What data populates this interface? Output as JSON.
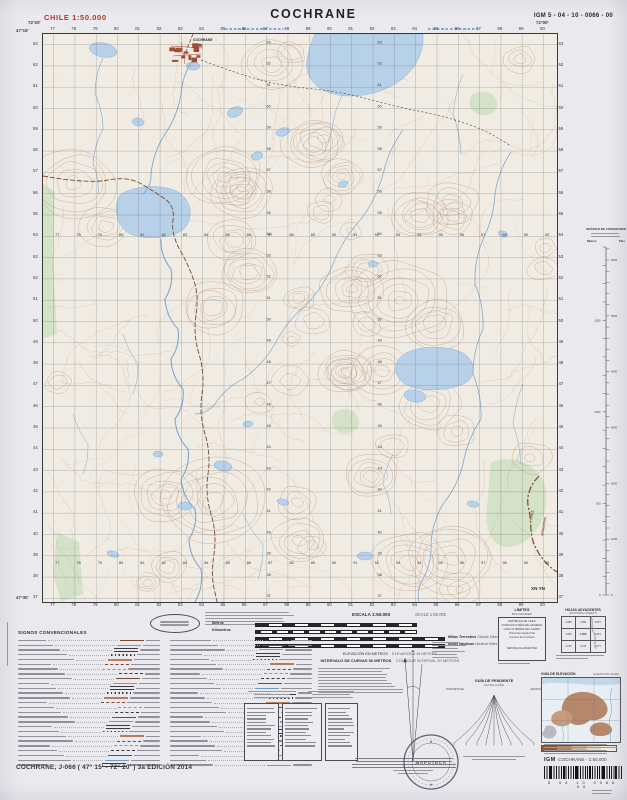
{
  "header": {
    "country_scale": "CHILE  1:50.000",
    "title": "COCHRANE",
    "sheet_code": "IGM 5 - 04 - 10 - 0066 - 00"
  },
  "map": {
    "town_label": "COCHRANE",
    "border_label_left": "CHILE",
    "border_label_right": "ARGENTINA",
    "zone_label": "XN YN",
    "corner_top_left_lon": "72°20'",
    "corner_top_right_lon": "72°00'",
    "corner_top_left_lat": "47°15'",
    "corner_bottom_left_lat": "47°30'",
    "grid": {
      "easting_start": 77,
      "easting_count": 24,
      "northing_start": 63,
      "northing_count": 27,
      "interior_rows": [
        202,
        530
      ],
      "interior_cols": [
        222,
        333
      ]
    }
  },
  "conversion": {
    "title": "GRÁFICO DE CONVERSIÓN",
    "col_meters": "Metros",
    "col_feet": "Pies",
    "meters_max": 1900,
    "meters_step": 100
  },
  "legend": {
    "signos_title": "SIGNOS CONVENCIONALES",
    "scale_es": "ESCALA 1:50.000",
    "scale_en": "SCALE 1:50.000",
    "scale_bars": [
      "Metros",
      "Kilómetros",
      "Millas Terrestres",
      "Millas Náuticas"
    ],
    "scale_bars_en": [
      "",
      "",
      "Statute Miles",
      "Nautical Miles"
    ],
    "elevation_es": "ELEVACIÓN EN METROS",
    "elevation_en": "ELEVATIONS IN METERS",
    "interval_es": "INTERVALO DE CURVAS 50 METROS",
    "interval_en": "CONTOUR INTERVAL 50 METERS",
    "limits": {
      "title_es": "LÍMITES",
      "title_en": "BOUNDARIES",
      "lines": [
        "REPÚBLICA DE CHILE",
        "XI REGIÓN AYSÉN DEL GENERAL",
        "CARLOS IBÁÑEZ DEL CAMPO",
        "Provincia Capitán Prat",
        "Comuna de Cochrane",
        "REPÚBLICA ARGENTINA"
      ]
    },
    "adjoining": {
      "title_es": "HOJAS ADYACENTES",
      "title_en": "ADJOINING SHEETS",
      "sheets": [
        "J-055",
        "J-056",
        "J-057",
        "J-065",
        "J-066",
        "J-067",
        "J-075",
        "J-076",
        "J-077"
      ],
      "current": "J-066"
    },
    "slope": {
      "title_es": "GUÍA DE PENDIENTE",
      "title_en": "SLOPE GUIDE",
      "left": "PORCENTAJE",
      "right": "GRADOS"
    },
    "elev_guide": {
      "title_es": "GUÍA DE ELEVACIÓN",
      "title_en": "ELEVATION GUIDE"
    }
  },
  "footer": {
    "edition": "COCHRANE, J-066 ( 47° 15' - 72° 20' ) 3a EDICIÓN 2014",
    "igm_label": "IGM",
    "product": "COCHRANE - 1:50.000",
    "barcode_digits": "5  04  10  0066  00",
    "stamp": "MAPOTECA"
  },
  "colors": {
    "contour": "#b5886b",
    "water_fill": "#b7d2e8",
    "water_line": "#7fa9cf",
    "vegetation": "#cfe0c2",
    "road": "#7a4a30",
    "town": "#9e4e38",
    "accent_red": "#b5352c"
  }
}
